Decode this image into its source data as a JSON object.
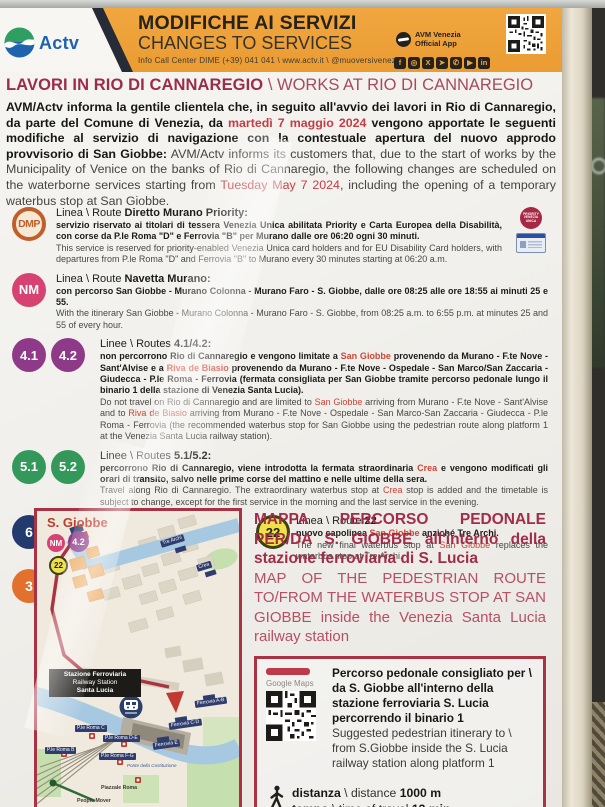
{
  "colors": {
    "banner_orange": "#efa23c",
    "title_red": "#9c2b4d",
    "accent_red": "#cf4435",
    "box_border_red": "#a93342"
  },
  "header": {
    "brand": "Actv",
    "title_it": "MODIFICHE AI SERVIZI",
    "title_en": "CHANGES TO SERVICES",
    "contact": "Info Call Center DIME (+39) 041 041 \\ www.actv.it \\ @muoversivenezia",
    "app_line1": "AVM Venezia",
    "app_line2": "Official App",
    "social": [
      {
        "name": "facebook",
        "glyph": "f"
      },
      {
        "name": "instagram",
        "glyph": "◎"
      },
      {
        "name": "x-twitter",
        "glyph": "X"
      },
      {
        "name": "telegram",
        "glyph": "➤"
      },
      {
        "name": "whatsapp",
        "glyph": "✆"
      },
      {
        "name": "youtube",
        "glyph": "▶"
      },
      {
        "name": "linkedin",
        "glyph": "in"
      }
    ]
  },
  "page_title": {
    "it": "LAVORI IN RIO DI CANNAREGIO",
    "sep": " \\ ",
    "en": "WORKS AT RIO DI CANNAREGIO"
  },
  "intro": {
    "it_before": "AVM/Actv informa la gentile clientela che, in seguito all'avvio dei lavori in Rio di Cannaregio, da parte del Comune di Venezia, da ",
    "it_date": "martedì 7 maggio 2024",
    "it_after": " vengono apportate le seguenti modifiche al servizio di navigazione con la contestuale apertura del nuovo approdo provvisorio di San Giobbe:",
    "en_before": "AVM/Actv informs its customers that, due to the start of works by the Municipality of Venice on the banks of Rio di Cannaregio, the following changes are scheduled on the waterborne services starting from ",
    "en_date": "Tuesday May 7 2024",
    "en_after": ", including the opening of a temporary waterbus stop at San Giobbe."
  },
  "routes": {
    "dmp": {
      "badge": "DMP",
      "title_pre": "Linea \\ Route ",
      "title_main": "Diretto Murano Priority:",
      "it": "servizio riservato ai titolari di tessera Venezia Unica abilitata Priority e Carta Europea della Disabilità, con corse da P.le Roma \"D\" e Ferrovia \"B\" per Murano dalle ore 06:20 ogni 30 minuti.",
      "en": "This service is reserved for priority-enabled Venezia Unica card holders and for EU Disability Card holders, with departures from P.le Roma \"D\" and Ferrovia \"B\" to Murano every 30 minutes starting at 06:20 a.m.",
      "icon_line1": "PRIORITY",
      "icon_line2": "VENEZIA UNICA"
    },
    "nm": {
      "badge": "NM",
      "title_pre": "Linea \\ Route ",
      "title_main": "Navetta Murano:",
      "it": "con percorso San Giobbe - Murano Colonna - Murano Faro - S. Giobbe, dalle ore 08:25 alle ore 18:55 ai minuti 25 e 55.",
      "en": "With the itinerary San Giobbe - Murano Colonna - Murano Faro - S. Giobbe, from 08:25 a.m. to 6:55 p.m. at minutes 25 and 55 of every hour."
    },
    "r41": {
      "badge1": "4.1",
      "badge2": "4.2",
      "title_pre": "Linee \\ Routes ",
      "title_main": "4.1/4.2:",
      "it": [
        "non percorrono Rio di Cannaregio e vengono limitate a ",
        "San Giobbe",
        " provenendo da Murano - F.te Nove - Sant'Alvise e a ",
        "Riva de Biasio",
        " provenendo da Murano - F.te Nove - Ospedale - San Marco/San Zaccaria - Giudecca - P.le Roma - Ferrovia (fermata consigliata per San Giobbe tramite percorso pedonale lungo il binario 1 della stazione di Venezia Santa Lucia)."
      ],
      "en": [
        "Do not travel on Rio di Cannaregio and are limited to ",
        "San Giobbe",
        " arriving from Murano - F.te Nove - Sant'Alvise and to ",
        "Riva de Biasio",
        " arriving from Murano - F.te Nove - Ospedale - San Marco-San Zaccaria - Giudecca - P.le Roma - Ferrovia (the recommended waterbus stop for San Giobbe using the pedestrian route along platform 1 at the Venezia Santa Lucia railway station)."
      ]
    },
    "r51": {
      "badge1": "5.1",
      "badge2": "5.2",
      "title_pre": "Linee \\ Routes ",
      "title_main": "5.1/5.2:",
      "it": [
        "percorrono Rio di Cannaregio, viene introdotta la fermata straordinaria ",
        "Crea",
        " e vengono modificati gli orari di transito, salvo nelle prime corse del mattino e nelle ultime della sera."
      ],
      "en": [
        "Travel along Rio di Cannaregio. The extraordinary waterbus stop at ",
        "Crea",
        " stop is added and the timetable is subject to change, except for the first service in the morning and the last service in the evening."
      ]
    },
    "r6": {
      "badge": "6",
      "title_pre": "Linea \\ Route ",
      "title_main": "6:",
      "it": "vengono modificati gli orari di transito.",
      "en": "The timetable of services are subject to change."
    },
    "r22": {
      "badge": "22",
      "title_pre": "Linea \\ Route ",
      "title_main": "22",
      "it": [
        "nuovo capolinea ",
        "San Giobbe",
        " anziché Tre Archi."
      ],
      "en": [
        "The new final waterbus stop at ",
        "San Giobbe",
        " replaces the waterbus stop at Tre Archi."
      ]
    },
    "r3": {
      "badge": "3",
      "title_pre": "Linea \\ Route ",
      "title_main": "3:",
      "it": "sospesa.",
      "en": "suspended."
    }
  },
  "map": {
    "area_label": "S. Giobbe",
    "badge_nm": "NM",
    "badge_42": "4.2",
    "badge_22": "22",
    "station_line1": "Stazione Ferroviaria",
    "station_line2": "Railway Station",
    "station_line3": "Santa Lucia",
    "labels": [
      "Tre Archi",
      "Crea",
      "Ferrovia A-B",
      "Ferrovia C-D",
      "Ferrovia E",
      "P.le Roma C",
      "P.le Roma D-E",
      "P.le Roma B",
      "P.le Roma F-G",
      "Ponte della Costituzione",
      "Piazzale Roma",
      "People Mover"
    ]
  },
  "mappa": {
    "it_1": "MAPPA PERCORSO PEDONALE PER/DA S. GIOBBE",
    "it_2": " all'interno della stazione ferroviaria di S. Lucia",
    "en": "MAP OF THE PEDESTRIAN ROUTE TO/FROM THE WATERBUS STOP AT SAN GIOBBE inside the Venezia Santa Lucia railway station"
  },
  "info_box": {
    "maps_label": "Google Maps",
    "it": "Percorso pedonale consigliato per \\ da S. Giobbe all'interno della stazione ferroviaria S. Lucia percorrendo il binario 1",
    "en": "Suggested pedestrian itinerary to \\ from S.Giobbe inside the S. Lucia railway station along platform 1",
    "distance_it": "distanza",
    "distance_sep": " \\ ",
    "distance_en": "distance ",
    "distance_value": "1000 m",
    "time_it": "tempo",
    "time_sep": " \\ ",
    "time_en": "time of travel ",
    "time_value": "13 min"
  }
}
